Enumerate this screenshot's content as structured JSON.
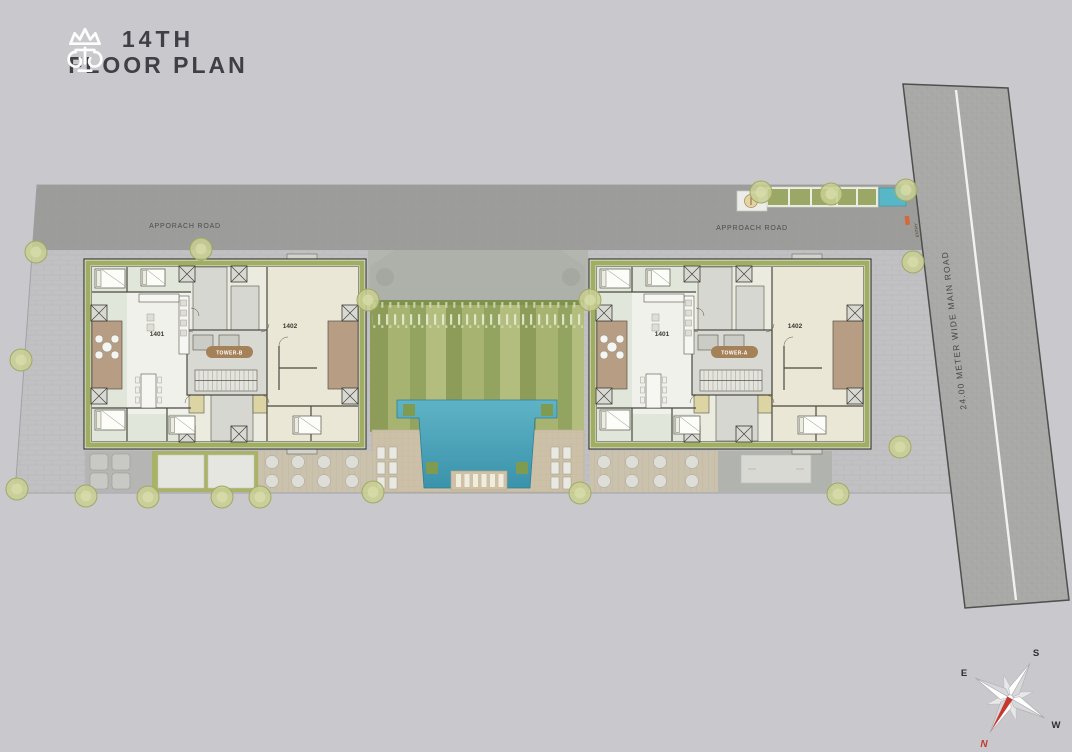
{
  "header": {
    "logo": "crown-icon",
    "title_line1": "14TH",
    "title_line2": "FLOOR PLAN"
  },
  "site": {
    "approach_road_left": "APPORACH ROAD",
    "approach_road_right": "APPROACH ROAD",
    "main_road": "24.00 METER WIDE MAIN ROAD",
    "entry": "ENTRY"
  },
  "towers": [
    {
      "badge": "TOWER-B",
      "unit_left": "1401",
      "unit_right": "1402"
    },
    {
      "badge": "TOWER-A",
      "unit_left": "1401",
      "unit_right": "1402"
    }
  ],
  "compass": {
    "north": "N",
    "south": "S",
    "east": "E",
    "west": "W"
  },
  "colors": {
    "page_bg": "#c9c9cd",
    "approach_road": "#9d9d9b",
    "main_road": "#a9a9a7",
    "frame_olive": "#9fae63",
    "lawn_green": "#9cab67",
    "pool_blue": "#4aa4bc",
    "deck_tan": "#ccc1a8",
    "balcony_brown": "#b79d84",
    "badge_brown": "#a5815a",
    "north_red": "#c5392e"
  }
}
